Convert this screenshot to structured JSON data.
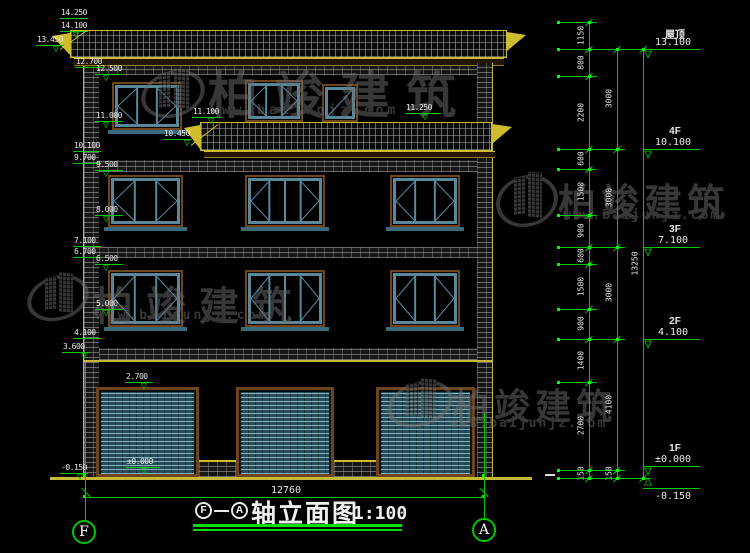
{
  "drawing": {
    "title": {
      "axis_start": "F",
      "axis_end": "A",
      "name": "轴立面图",
      "scale": "1:100"
    },
    "bottom_dimension": "12760",
    "grid_axes": [
      {
        "label": "F"
      },
      {
        "label": "A"
      }
    ],
    "watermark": {
      "brand": "柏竣建筑",
      "url": "www.baijunjz.com",
      "instances": [
        {
          "logo": {
            "x": 142,
            "y": 66,
            "w": 62,
            "h": 56
          },
          "text": {
            "x": 208,
            "y": 56,
            "size": 50,
            "ls": 16
          },
          "url_pos": {
            "x": 210,
            "y": 103,
            "size": 13,
            "ls": 4
          }
        },
        {
          "logo": {
            "x": 497,
            "y": 170,
            "w": 60,
            "h": 62
          },
          "text": {
            "x": 558,
            "y": 172,
            "size": 38,
            "ls": 5
          },
          "url_pos": {
            "x": 563,
            "y": 208,
            "size": 13,
            "ls": 2
          }
        },
        {
          "logo": {
            "x": 28,
            "y": 271,
            "w": 60,
            "h": 54
          },
          "text": {
            "x": 93,
            "y": 274,
            "size": 40,
            "ls": 13
          },
          "url_pos": {
            "x": 96,
            "y": 308,
            "size": 13,
            "ls": 3
          }
        },
        {
          "logo": {
            "x": 388,
            "y": 377,
            "w": 64,
            "h": 54
          },
          "text": {
            "x": 453,
            "y": 378,
            "size": 36,
            "ls": 5
          },
          "url_pos": {
            "x": 450,
            "y": 416,
            "size": 13,
            "ls": 2
          }
        }
      ]
    },
    "elevation_markers": [
      {
        "label": "14.250",
        "x": 60,
        "y": 18
      },
      {
        "label": "14.100",
        "x": 60,
        "y": 31,
        "tri": true,
        "tx": 70
      },
      {
        "label": "13.450",
        "x": 36,
        "y": 45,
        "tri": true,
        "tx": 50
      },
      {
        "label": "12.700",
        "x": 75,
        "y": 67
      },
      {
        "label": "12.500",
        "x": 95,
        "y": 74,
        "tri": true,
        "tx": 100
      },
      {
        "label": "11.000",
        "x": 95,
        "y": 121,
        "tri": true,
        "tx": 100
      },
      {
        "label": "10.100",
        "x": 73,
        "y": 151
      },
      {
        "label": "9.700",
        "x": 73,
        "y": 163
      },
      {
        "label": "9.500",
        "x": 95,
        "y": 170,
        "tri": true,
        "tx": 100
      },
      {
        "label": "8.000",
        "x": 95,
        "y": 215,
        "tri": true,
        "tx": 100
      },
      {
        "label": "7.100",
        "x": 73,
        "y": 246
      },
      {
        "label": "6.700",
        "x": 73,
        "y": 257
      },
      {
        "label": "6.500",
        "x": 95,
        "y": 264,
        "tri": true,
        "tx": 100
      },
      {
        "label": "5.000",
        "x": 95,
        "y": 309,
        "tri": true,
        "tx": 100
      },
      {
        "label": "4.100",
        "x": 73,
        "y": 338
      },
      {
        "label": "3.600",
        "x": 62,
        "y": 352,
        "tri": true,
        "tx": 78
      },
      {
        "label": "2.700",
        "x": 125,
        "y": 382,
        "tri": true,
        "tx": 138
      },
      {
        "label": "±0.000",
        "x": 126,
        "y": 467,
        "w": 34,
        "tri": true,
        "tx": 138
      },
      {
        "label": "-0.150",
        "x": 60,
        "y": 473,
        "tri": true,
        "tx": 74
      },
      {
        "label": "11.100",
        "x": 192,
        "y": 117,
        "w": 30,
        "tri": true,
        "tx": 205
      },
      {
        "label": "10.450",
        "x": 163,
        "y": 139,
        "tri": true,
        "tx": 181
      },
      {
        "label": "11.250",
        "x": 405,
        "y": 113,
        "w": 36,
        "tri": true,
        "tx": 419
      }
    ],
    "leaders": [
      {
        "x1": 60,
        "y1": 49,
        "x2": 87,
        "y2": 30
      },
      {
        "x1": 191,
        "y1": 145,
        "x2": 218,
        "y2": 124
      }
    ],
    "right_dimensions": {
      "chains": [
        {
          "x": 589,
          "ext_to": 597,
          "ticks": [
            22,
            49,
            76,
            149,
            169,
            215,
            247,
            264,
            309,
            339,
            382,
            470,
            478
          ],
          "labels": [
            "1150",
            "800",
            "2200",
            "600",
            "1500",
            "900",
            "600",
            "1500",
            "900",
            "1400",
            "2700",
            "150"
          ]
        },
        {
          "x": 617,
          "ext_to": 625,
          "ticks": [
            49,
            149,
            247,
            339,
            470,
            478
          ],
          "labels": [
            "3000",
            "3000",
            "3000",
            "4100",
            "150"
          ]
        },
        {
          "x": 643,
          "ext_to": 651,
          "ticks": [
            49,
            478
          ],
          "labels": [
            "13250"
          ]
        }
      ],
      "floor_levels": [
        {
          "name": "屋顶",
          "elev": "13.100",
          "y": 49
        },
        {
          "name": "4F",
          "elev": "10.100",
          "y": 149
        },
        {
          "name": "3F",
          "elev": "7.100",
          "y": 247
        },
        {
          "name": "2F",
          "elev": "4.100",
          "y": 339
        },
        {
          "name": "1F",
          "elev": "±0.000",
          "y": 466,
          "bowtie": true
        },
        {
          "name": "",
          "elev": "-0.150",
          "y": 488,
          "below": true
        }
      ]
    },
    "windows": [
      {
        "x": 112,
        "y": 82,
        "w": 70,
        "h": 48,
        "panes": 3,
        "sill": true
      },
      {
        "x": 245,
        "y": 80,
        "w": 58,
        "h": 42,
        "panes": 3
      },
      {
        "x": 322,
        "y": 84,
        "w": 36,
        "h": 38,
        "door": true
      },
      {
        "x": 108,
        "y": 175,
        "w": 75,
        "h": 52,
        "panes": 3,
        "sill": true
      },
      {
        "x": 245,
        "y": 175,
        "w": 80,
        "h": 52,
        "panes": 4,
        "sill": true
      },
      {
        "x": 390,
        "y": 175,
        "w": 70,
        "h": 52,
        "panes": 3,
        "sill": true
      },
      {
        "x": 108,
        "y": 270,
        "w": 75,
        "h": 57,
        "panes": 3,
        "sill": true
      },
      {
        "x": 245,
        "y": 270,
        "w": 80,
        "h": 57,
        "panes": 4,
        "sill": true
      },
      {
        "x": 390,
        "y": 270,
        "w": 70,
        "h": 57,
        "panes": 3,
        "sill": true
      }
    ],
    "garage_doors": [
      {
        "x": 96,
        "y": 387,
        "w": 103,
        "h": 90
      },
      {
        "x": 236,
        "y": 387,
        "w": 98,
        "h": 90
      },
      {
        "x": 376,
        "y": 387,
        "w": 99,
        "h": 90
      }
    ],
    "low_walls": [
      {
        "x": 199,
        "w": 37
      },
      {
        "x": 334,
        "w": 42
      }
    ],
    "colors": {
      "line_green": "#00c800",
      "bright_green": "#00ff00",
      "cad_yellow": "#cdbd2e",
      "frame_brown": "#6e441d",
      "frame_teal": "#58889c",
      "shutter_teal": "#2a4d57",
      "watermark_gray": "#6f6f6f"
    }
  }
}
